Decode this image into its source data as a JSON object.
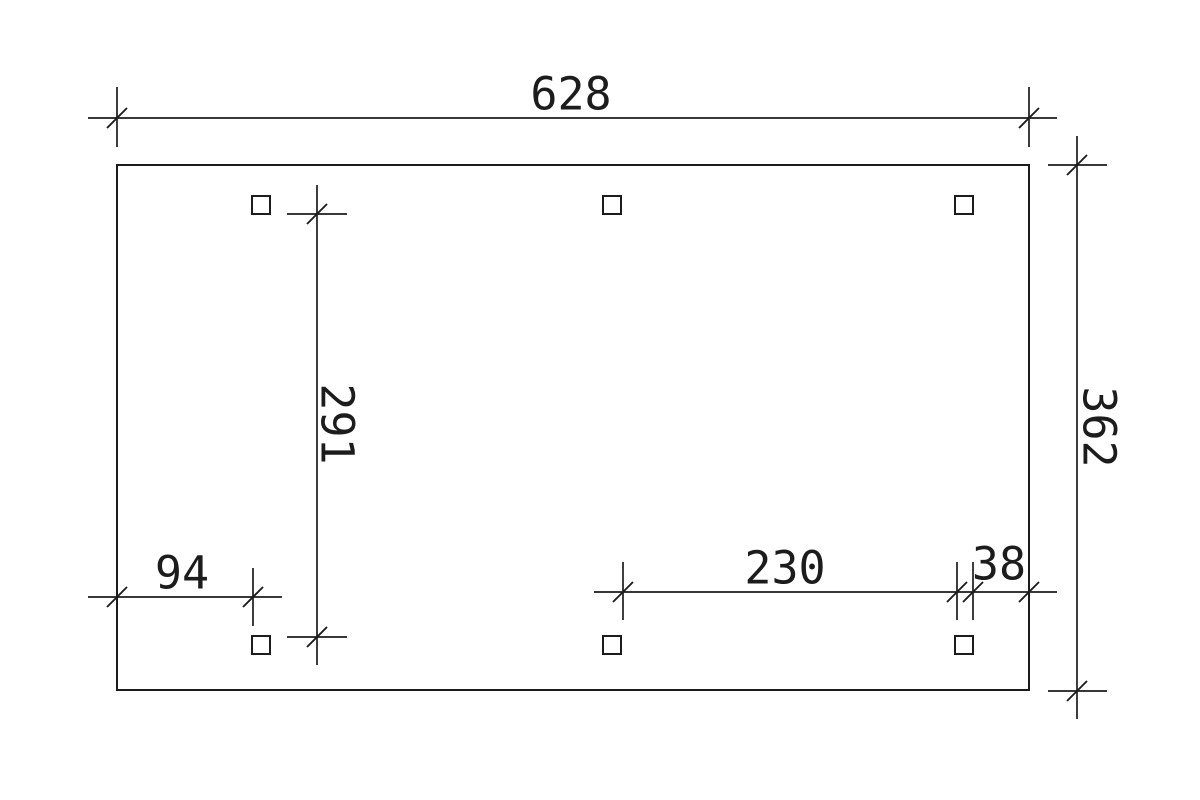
{
  "dimensions": {
    "top_width": "628",
    "right_height": "362",
    "inner_vertical": "291",
    "bottom_left": "94",
    "bottom_center": "230",
    "bottom_right": "38"
  },
  "posts": {
    "count": 6,
    "shape": "square"
  },
  "colors": {
    "line": "#1c1c1c",
    "background": "#ffffff"
  }
}
